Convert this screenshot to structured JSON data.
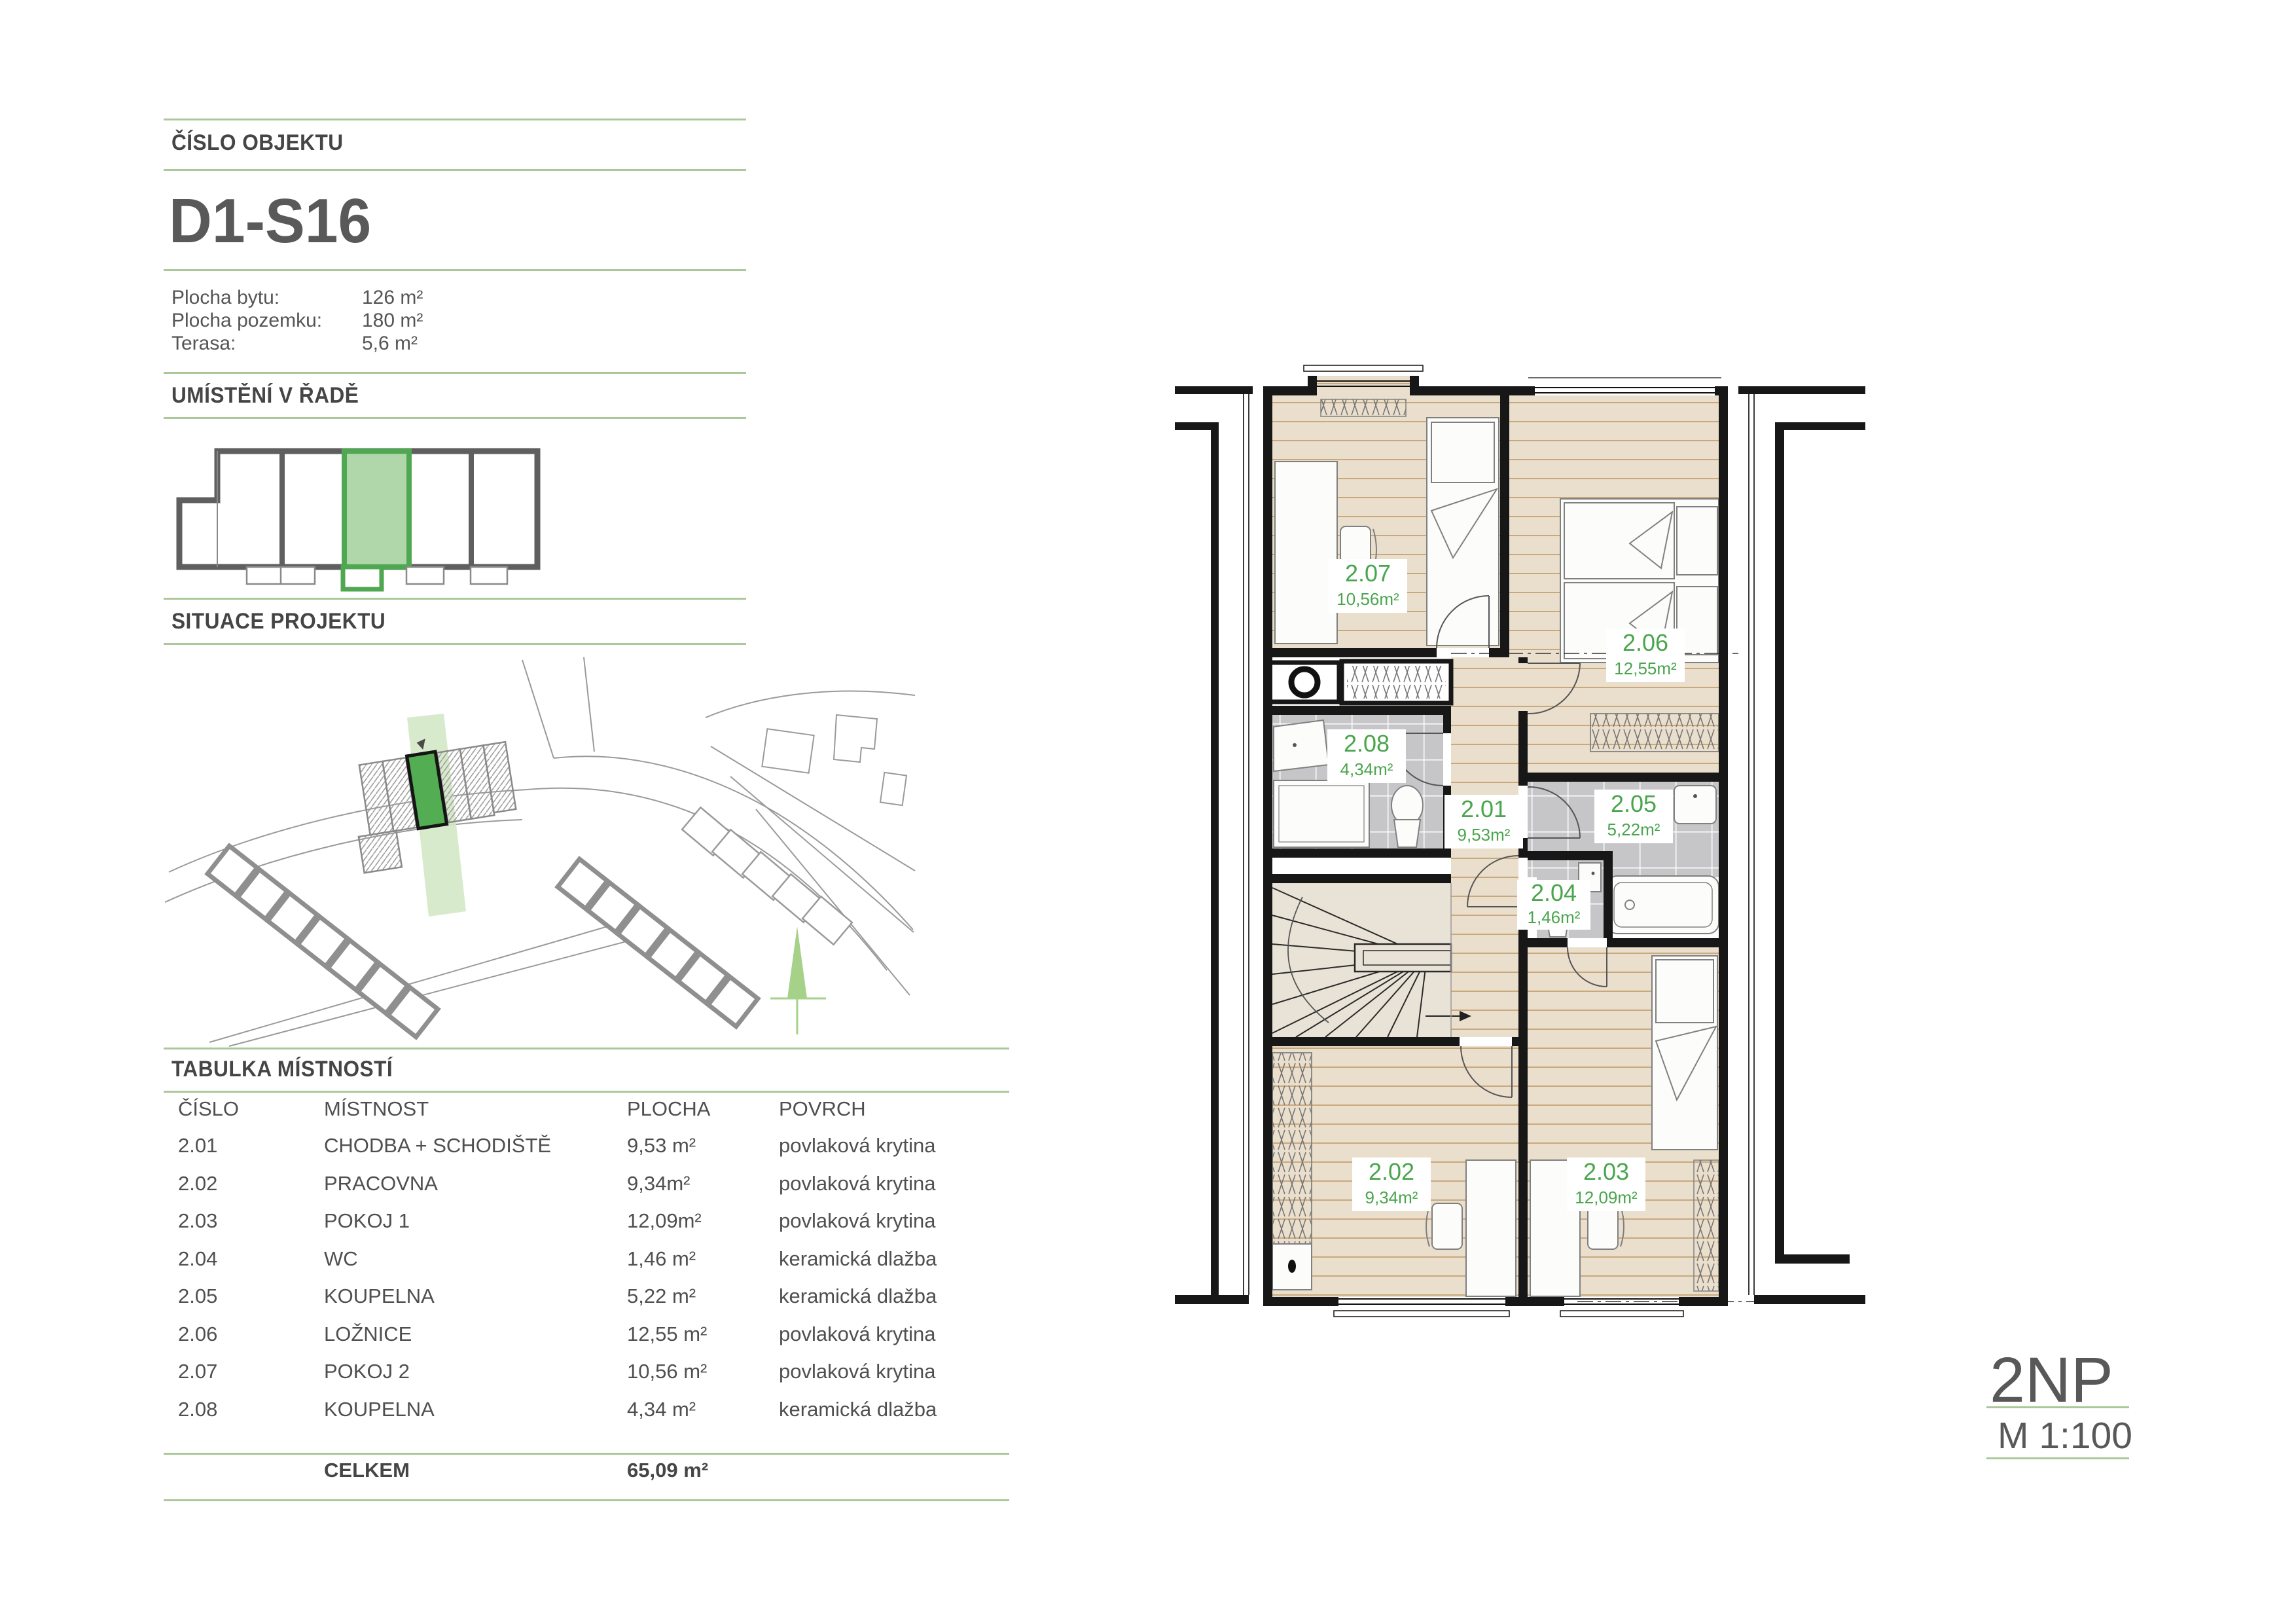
{
  "panel": {
    "section1_title": "ČÍSLO OBJEKTU",
    "object_id": "D1-S16",
    "stats": [
      {
        "label": "Plocha bytu:",
        "value": "126 m²"
      },
      {
        "label": "Plocha pozemku:",
        "value": "180 m²"
      },
      {
        "label": "Terasa:",
        "value": "5,6 m²"
      }
    ],
    "section2_title": "UMÍSTĚNÍ V ŘADĚ",
    "section3_title": "SITUACE PROJEKTU",
    "table": {
      "title": "TABULKA MÍSTNOSTÍ",
      "headers": [
        "ČÍSLO",
        "MÍSTNOST",
        "PLOCHA",
        "POVRCH"
      ],
      "rows": [
        {
          "cislo": "2.01",
          "mistnost": "CHODBA + SCHODIŠTĚ",
          "plocha": "9,53 m²",
          "povrch": "povlaková krytina"
        },
        {
          "cislo": "2.02",
          "mistnost": "PRACOVNA",
          "plocha": "9,34m²",
          "povrch": "povlaková krytina"
        },
        {
          "cislo": "2.03",
          "mistnost": "POKOJ 1",
          "plocha": "12,09m²",
          "povrch": "povlaková krytina"
        },
        {
          "cislo": "2.04",
          "mistnost": "WC",
          "plocha": "1,46 m²",
          "povrch": "keramická dlažba"
        },
        {
          "cislo": "2.05",
          "mistnost": "KOUPELNA",
          "plocha": "5,22 m²",
          "povrch": "keramická dlažba"
        },
        {
          "cislo": "2.06",
          "mistnost": "LOŽNICE",
          "plocha": "12,55 m²",
          "povrch": "povlaková krytina"
        },
        {
          "cislo": "2.07",
          "mistnost": "POKOJ 2",
          "plocha": "10,56 m²",
          "povrch": "povlaková krytina"
        },
        {
          "cislo": "2.08",
          "mistnost": "KOUPELNA",
          "plocha": "4,34 m²",
          "povrch": "keramická dlažba"
        }
      ],
      "total_label": "CELKEM",
      "total_value": "65,09 m²"
    }
  },
  "plan": {
    "rooms": [
      {
        "id": "2.01",
        "area": "9,53m²"
      },
      {
        "id": "2.02",
        "area": "9,34m²"
      },
      {
        "id": "2.03",
        "area": "12,09m²"
      },
      {
        "id": "2.04",
        "area": "1,46m²"
      },
      {
        "id": "2.05",
        "area": "5,22m²"
      },
      {
        "id": "2.06",
        "area": "12,55m²"
      },
      {
        "id": "2.07",
        "area": "10,56m²"
      },
      {
        "id": "2.08",
        "area": "4,34m²"
      }
    ],
    "floor_label": "2NP",
    "scale_label": "M 1:100"
  },
  "colors": {
    "accent_green": "#4aa54d",
    "rule_green": "#abc898",
    "diagram_green_fill": "#a4d29e",
    "diagram_green_stroke": "#4fa851",
    "map_green_unit": "#53ad53",
    "map_green_band": "#d4e8c6",
    "tree_green": "#a6d189",
    "heading_gray": "#454545",
    "wall_black": "#171717",
    "wood_floor": "#eadfcc",
    "wood_line": "#c9a87e",
    "tile_gray": "#c6c6c8",
    "stairs_beige": "#e9e3d7",
    "diagram_gray": "#5f5f5f"
  }
}
